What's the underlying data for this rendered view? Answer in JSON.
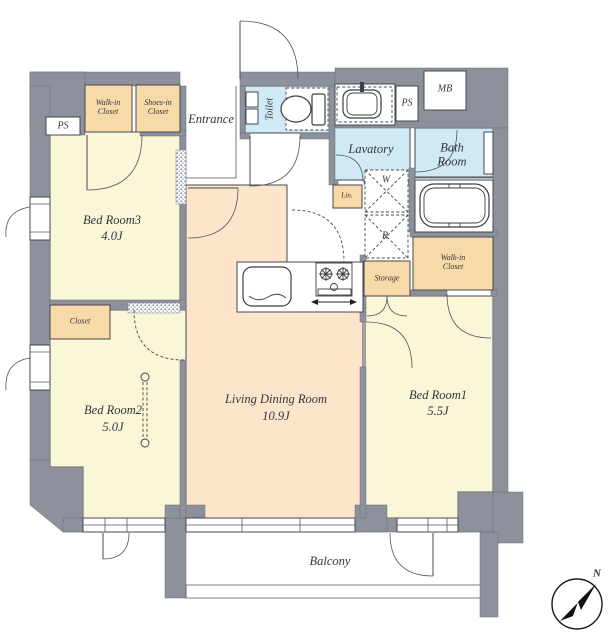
{
  "colors": {
    "wall": "#8c919b",
    "bedroom": "#faf6d8",
    "ldk": "#fce5cb",
    "wet": "#cfe9f5",
    "closet": "#f8d9a8"
  },
  "labels": {
    "entrance": "Entrance",
    "toilet": "Toilet",
    "lavatory": "Lavatory",
    "bath_room": "Bath\nRoom",
    "walk_in_closet_top": "Walk-in\nCloset",
    "shoes_in_closet": "Shoes-in\nCloset",
    "walk_in_closet_right": "Walk-in\nCloset",
    "closet": "Closet",
    "ps_left": "PS",
    "ps_right": "PS",
    "mb": "MB",
    "washer": "W",
    "refrigerator": "R",
    "linen": "Lin.",
    "storage": "Storage",
    "balcony": "Balcony",
    "compass_north": "N"
  },
  "rooms": {
    "bed_room3": {
      "name": "Bed Room3",
      "size": "4.0J"
    },
    "bed_room2": {
      "name": "Bed Room2",
      "size": "5.0J"
    },
    "bed_room1": {
      "name": "Bed Room1",
      "size": "5.5J"
    },
    "living_dining": {
      "name": "Living Dining Room",
      "size": "10.9J"
    }
  }
}
